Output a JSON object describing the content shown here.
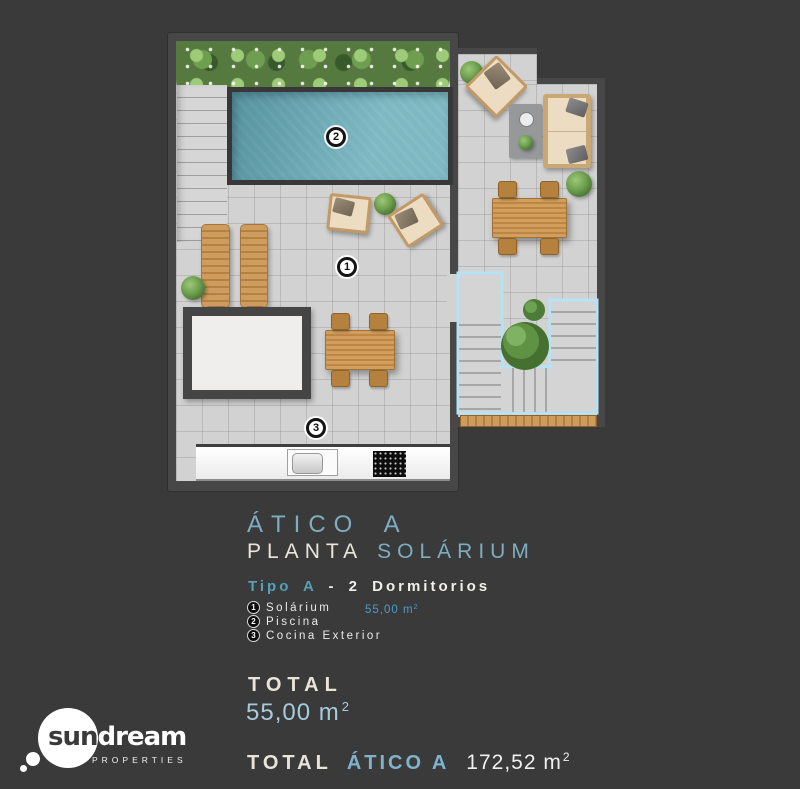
{
  "title": {
    "line1": "ÁTICO A",
    "planta": "PLANTA",
    "solarium": "SOLÁRIUM"
  },
  "subtitle": {
    "tipo": "Tipo A",
    "rest": "- 2 Dormitorios"
  },
  "legend": {
    "items": [
      {
        "num": "1",
        "label": "Solárium",
        "value": "55,00 m",
        "sup": "2"
      },
      {
        "num": "2",
        "label": "Piscina"
      },
      {
        "num": "3",
        "label": "Cocina Exterior"
      }
    ]
  },
  "total": {
    "label": "TOTAL",
    "value": "55,00 m",
    "sup": "2"
  },
  "grand_total": {
    "label": "TOTAL",
    "unit_name": "ÁTICO A",
    "value": "172,52 m",
    "sup": "2"
  },
  "plan": {
    "label_terrace": "1",
    "label_pool": "2",
    "label_kitchen": "3"
  },
  "logo": {
    "sun": "sun",
    "dream": "dream",
    "tagline": "PROPERTIES"
  },
  "colors": {
    "background": "#3a3a3a",
    "accent_blue": "#7fadc0",
    "teal": "#55a1b7",
    "legend_value_blue": "#4a9cc9",
    "cream": "#e9e5da",
    "pool_water": "#68acb9",
    "floor": "#d2d2d2",
    "wall": "#474747",
    "stairs_outline": "#b6e2f5"
  }
}
